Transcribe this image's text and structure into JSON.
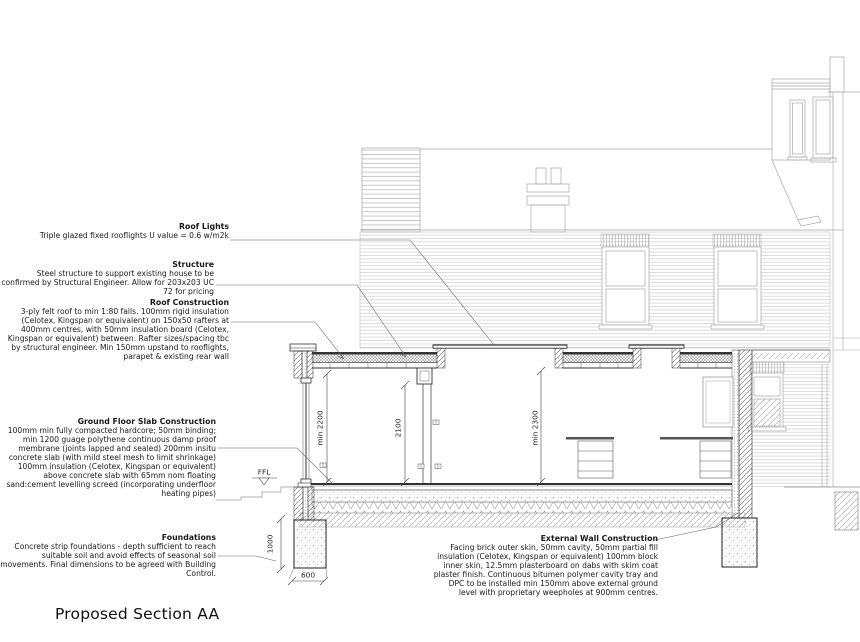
{
  "page": {
    "title": "Proposed Section AA"
  },
  "annotations": {
    "roof_lights": {
      "title": "Roof Lights",
      "body": "Triple glazed fixed rooflights U value = 0.6 w/m2k"
    },
    "structure": {
      "title": "Structure",
      "body": "Steel structure to support existing house to be confirmed by Structural Engineer. Allow for 203x203 UC 72 for pricing"
    },
    "roof_construction": {
      "title": "Roof Construction",
      "body": "3-ply felt roof to min 1:80 falls. 100mm rigid insulation (Celotex, Kingspan or equivalent) on 150x50 rafters at 400mm centres, with 50mm insulation board (Celotex, Kingspan or equivalent) between. Rafter sizes/spacing tbc by structural engineer. Min 150mm upstand to rooflights, parapet & existing rear wall"
    },
    "ground_floor_slab": {
      "title": "Ground Floor Slab Construction",
      "body": "100mm min fully compacted hardcore; 50mm binding; min 1200 guage polythene continuous damp proof membrane (joints lapped and sealed) 200mm insitu concrete slab (with mild steel mesh to limit shrinkage) 100mm insulation (Celotex, Kingspan or equivalent) above concrete slab with 65mm nom floating sand:cement levelling screed (incorporating underfloor heating pipes)"
    },
    "foundations": {
      "title": "Foundations",
      "body": "Concrete strip foundations - depth sufficient to reach suitable soil and avoid effects of seasonal soil movements. Final dimensions to be agreed with Building Control."
    },
    "external_wall": {
      "title": "External Wall Construction",
      "body": "Facing brick outer skin, 50mm cavity, 50mm partial fill insulation (Celotex, Kingspan or equivalent) 100mm block inner skin, 12.5mm plasterboard on dabs with skim coat plaster finish. Continuous bitumen polymer cavity tray and DPC to be installed min 150mm above external ground level with proprietary weepholes at 900mm centres."
    }
  },
  "dimensions": {
    "ceiling_height": "min 2200",
    "opening_height": "2100",
    "rear_ceiling_height": "min 2300",
    "foundation_depth": "1000",
    "foundation_width": "600",
    "floor_level": "FFL"
  },
  "colors": {
    "line_dark": "#222222",
    "line_light": "#a8a8a8",
    "paper": "#ffffff"
  }
}
